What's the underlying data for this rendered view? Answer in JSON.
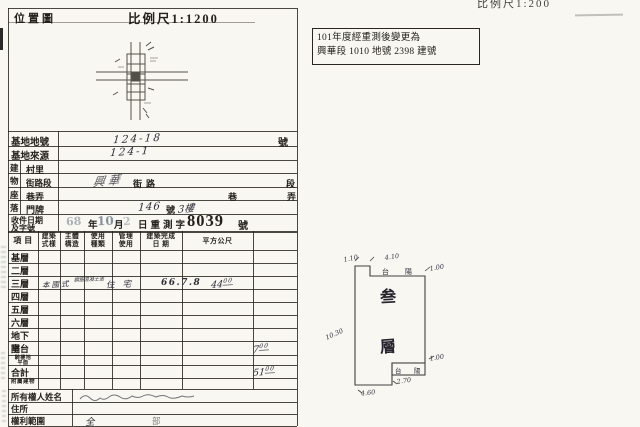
{
  "palette": {
    "paper": "#f8f7f2",
    "ink": "#24211c",
    "stamp_ink": "#6e7a87",
    "hand_ink": "#2e2d36"
  },
  "map_panel": {
    "title": "位置圖",
    "scale_label": "比例尺1:1200"
  },
  "top_right": {
    "scale_label": "比例尺1:200"
  },
  "note_box": {
    "line1": "101年度經重測後變更為",
    "line2": "興華段 1010 地號 2398 建號"
  },
  "site_rows": {
    "lot_label": "基地地號",
    "lot_value": "124-18",
    "lot_unit": "號",
    "src_label": "基地來源",
    "src_value": "124-1"
  },
  "location_rows": {
    "group_chars": [
      "建",
      "物",
      "座",
      "落"
    ],
    "village_label": "村里",
    "street_label": "街路段",
    "street_hand": "興華",
    "street_print": "街路",
    "street_unit": "段",
    "lane_label": "巷弄",
    "lane_print": "巷",
    "lane_unit": "弄",
    "door_label": "門牌",
    "door_hand": "146",
    "door_print": "號",
    "door_floor": "3樓"
  },
  "receipt_row": {
    "label1": "收件日期",
    "label2": "及字號",
    "year": "68",
    "y_unit": "年",
    "month": "10",
    "m_unit": "月",
    "day": "2",
    "print_text": "日重測字",
    "number": "8039",
    "unit": "號"
  },
  "floors_table": {
    "headers": [
      [
        "項 目",
        ""
      ],
      [
        "建築",
        "式樣"
      ],
      [
        "主體",
        "構造"
      ],
      [
        "使用",
        "種類"
      ],
      [
        "管理",
        "使用"
      ],
      [
        "建築完成",
        "日 期"
      ],
      [
        "平方公尺",
        ""
      ]
    ],
    "rows": [
      {
        "label": "基層"
      },
      {
        "label": "二層"
      },
      {
        "label": "三層",
        "style": "本國式",
        "structure": "鋼筋混凝土造",
        "use": "住宅",
        "completed": "66.7.8",
        "area": "44.00"
      },
      {
        "label": "四層"
      },
      {
        "label": "五層"
      },
      {
        "label": "六層"
      },
      {
        "label": "地下室"
      },
      {
        "label": "陽台",
        "area": "7.00"
      },
      {
        "label": "騎樓地",
        "label2": "平面",
        "small": true
      },
      {
        "label": "合計",
        "area": "51.00"
      },
      {
        "label": "附屬建物",
        "small": true
      }
    ]
  },
  "owner_rows": {
    "name_label": "所有權人姓名",
    "addr_label": "住所",
    "rights_label": "權利範圍",
    "rights_a": "全",
    "rights_b": "部"
  },
  "floorplan": {
    "floor_text": [
      "叁",
      "層"
    ],
    "balcony_top": [
      "台",
      "陽"
    ],
    "balcony_bottom": [
      "台",
      "陽"
    ],
    "dims": {
      "top_offset": "1.10",
      "top_width": "4.10",
      "top_depth": "1.00",
      "left_height": "10.30",
      "balcony_depth": "1.00",
      "balcony_width": "2.70",
      "bottom_offset": "4.60"
    }
  }
}
